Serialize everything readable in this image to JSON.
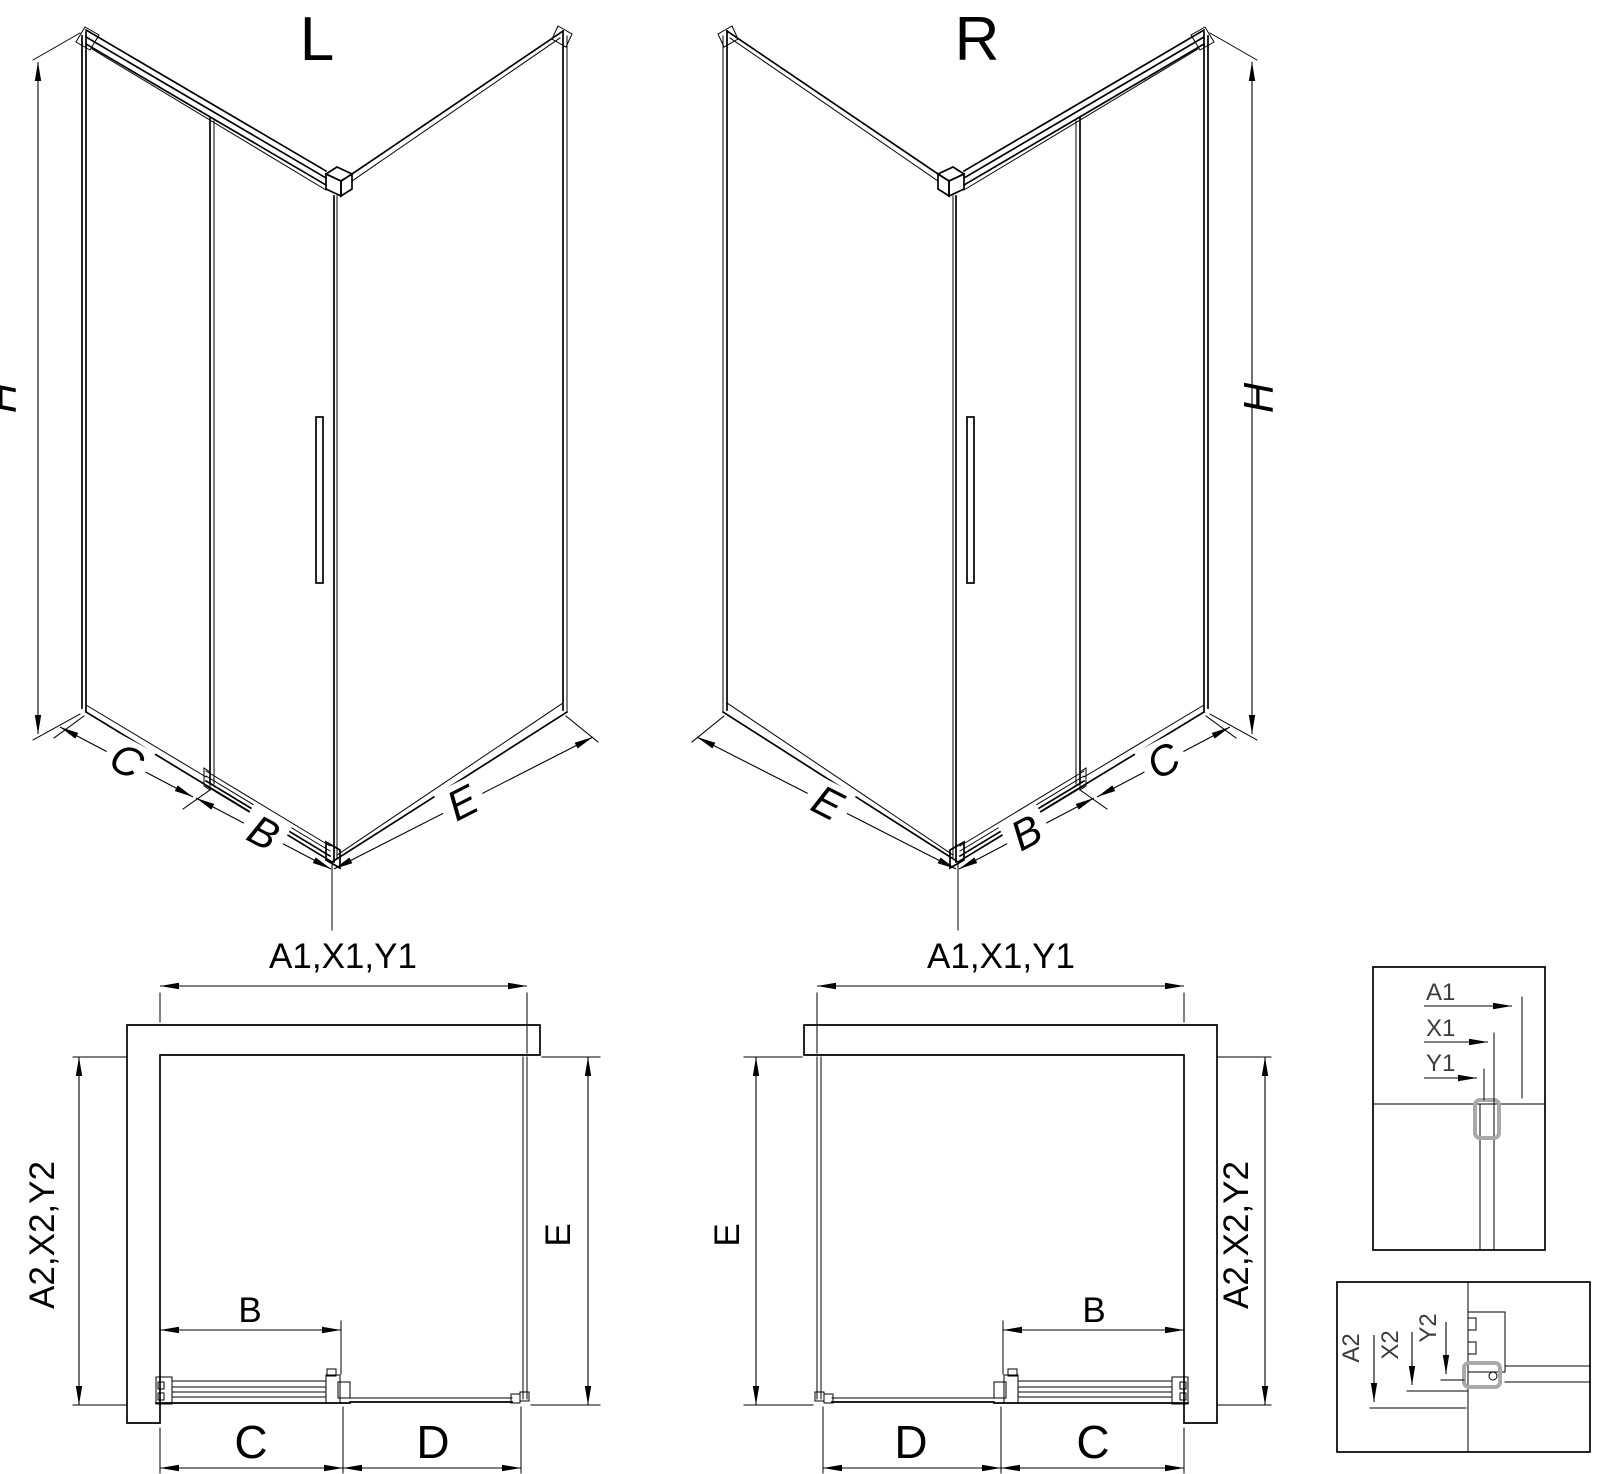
{
  "drawing": {
    "type": "shower-enclosure-dimension-diagram",
    "variants": [
      "L",
      "R"
    ]
  },
  "iso_left": {
    "title": "L",
    "h": "H",
    "c": "C",
    "b": "B",
    "e": "E"
  },
  "iso_right": {
    "title": "R",
    "h": "H",
    "e": "E",
    "b": "B",
    "c": "C"
  },
  "plan_left": {
    "width_label": "A1,X1,Y1",
    "depth_label": "A2,X2,Y2",
    "e": "E",
    "b": "B",
    "c": "C",
    "d": "D"
  },
  "plan_right": {
    "width_label": "A1,X1,Y1",
    "depth_label": "A2,X2,Y2",
    "e": "E",
    "b": "B",
    "d": "D",
    "c": "C"
  },
  "detail_top": {
    "rows": [
      "A1",
      "X1",
      "Y1"
    ]
  },
  "detail_bottom": {
    "rows": [
      "A2",
      "X2",
      "Y2"
    ]
  },
  "colors": {
    "line": "#000000",
    "profile_gray": "#a9a9a9",
    "background": "#ffffff"
  }
}
